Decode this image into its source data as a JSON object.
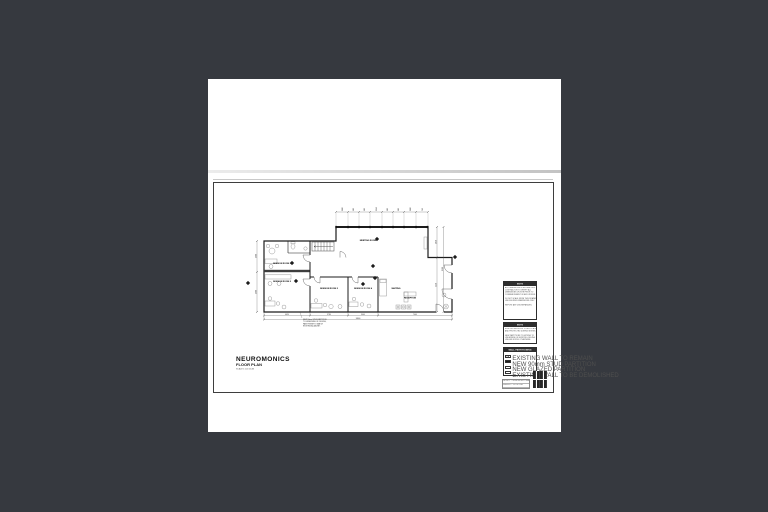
{
  "colors": {
    "background": "#36393f",
    "sheet": "#ffffff",
    "wall_line": "#1c1c1c",
    "fixture_line": "#8f8f8f",
    "note_header_bar": "#2e2e2e"
  },
  "drawing": {
    "title": "NEUROMONICS",
    "subtitle": "FLOOR PLAN",
    "scale_text": "SCALE 1:100 @ A3",
    "rooms": [
      {
        "label": "SESSION ROOM 1"
      },
      {
        "label": "SESSION ROOM 2"
      },
      {
        "label": "SESSION ROOM 3"
      },
      {
        "label": "SESSION ROOM 4"
      },
      {
        "label": "WAITING"
      },
      {
        "label": "RECEPTION"
      },
      {
        "label": "MEETING ROOM"
      }
    ],
    "plan_note_lines": [
      "NEW 90mm STUD PARTITION",
      "TO UNDERSIDE OF CEILING,",
      "PAINT FINISH TO MATCH",
      "EXISTING ADJACENT."
    ],
    "top_dimensions": [
      "1180",
      "900",
      "900",
      "1240",
      "900",
      "900",
      "1180",
      "760"
    ],
    "bottom_dimensions": [
      "4620",
      "3780",
      "3400",
      "7000"
    ],
    "bottom_total": "18800",
    "right_dimensions": [
      "3050",
      "5450"
    ],
    "right_total": "8500",
    "left_dimensions": [
      "2900",
      "3900"
    ]
  },
  "notes_panel": {
    "box1": {
      "title": "NOTE",
      "lines": [
        "ALL DIMENSIONS IN MILLIMETRES.",
        "CONTRACTOR TO VERIFY ALL",
        "DIMENSIONS ON SITE PRIOR TO",
        "COMMENCEMENT OF ANY WORKS.",
        "",
        "DO NOT SCALE FROM THIS DRAWING.",
        "USE FIGURED DIMENSIONS ONLY.",
        "",
        "REPORT ANY DISCREPANCIES."
      ]
    },
    "box2": {
      "title": "NOTE",
      "lines": [
        "EXISTING SERVICES TO BE LOCATED",
        "AND PROTECTED DURING WORKS.",
        "",
        "NEW PARTITIONS TO EXTEND TO",
        "UNDERSIDE OF EXISTING CEILING",
        "UNLESS NOTED OTHERWISE."
      ]
    },
    "legend": {
      "title": "WALL PARTITIONING",
      "items": [
        {
          "label": "EXISTING WALL TO REMAIN"
        },
        {
          "label": "NEW 90mm STUD PARTITION"
        },
        {
          "label": "NEW GLAZED PARTITION"
        },
        {
          "label": "EXISTING WALL TO BE DEMOLISHED"
        }
      ]
    }
  },
  "title_block": {
    "rows": [
      "PROJECT — NEUROMONICS TENANCY FITOUT",
      "DRAWING — FLOOR PLAN",
      "SCALE 1:100 @ A3 · DWG A-01 · REV A"
    ]
  }
}
